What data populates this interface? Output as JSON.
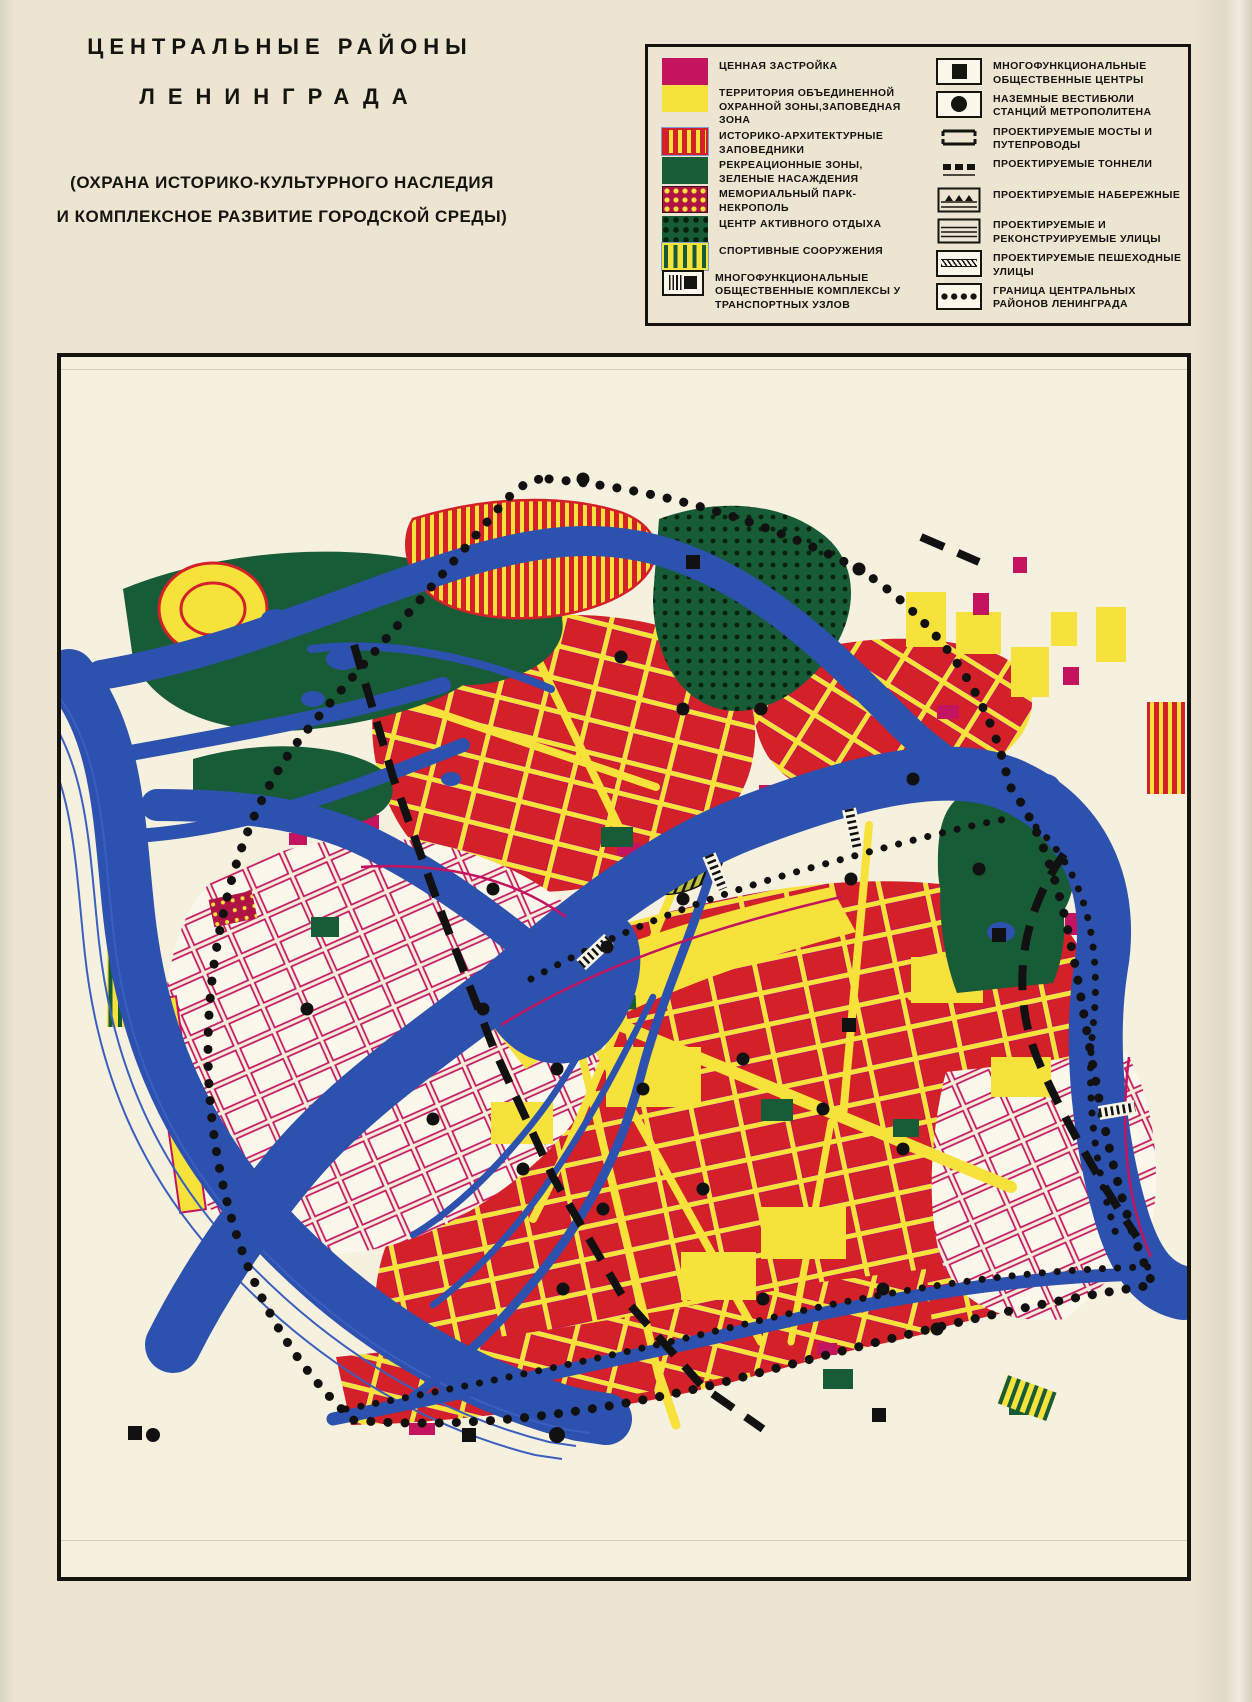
{
  "title": {
    "line1": "ЦЕНТРАЛЬНЫЕ РАЙОНЫ",
    "line2": "ЛЕНИНГРАДА",
    "subtitle_line1": "(ОХРАНА ИСТОРИКО-КУЛЬТУРНОГО НАСЛЕДИЯ",
    "subtitle_line2": "И КОМПЛЕКСНОЕ РАЗВИТИЕ ГОРОДСКОЙ СРЕДЫ)"
  },
  "legend": {
    "left": [
      {
        "id": "valuable-buildings",
        "swatch": "solid-crimson",
        "label": "ЦЕННАЯ ЗАСТРОЙКА"
      },
      {
        "id": "protected-zone",
        "swatch": "solid-yellow",
        "label": "ТЕРРИТОРИЯ ОБЪЕДИНЕННОЙ ОХРАННОЙ ЗОНЫ,ЗАПОВЕДНАЯ ЗОНА"
      },
      {
        "id": "historic-architectural-reserves",
        "swatch": "stripes-red-yellow",
        "label": "ИСТОРИКО-АРХИТЕКТУРНЫЕ ЗАПОВЕДНИКИ"
      },
      {
        "id": "recreation-zones",
        "swatch": "solid-green",
        "label": "РЕКРЕАЦИОННЫЕ ЗОНЫ, ЗЕЛЕНЫЕ НАСАЖДЕНИЯ"
      },
      {
        "id": "memorial-park-necropolis",
        "swatch": "dots-yellow-on-crimson",
        "label": "МЕМОРИАЛЬНЫЙ ПАРК-НЕКРОПОЛЬ"
      },
      {
        "id": "active-recreation-center",
        "swatch": "dots-black-on-green",
        "label": "ЦЕНТР АКТИВНОГО ОТДЫХА"
      },
      {
        "id": "sports-facilities",
        "swatch": "stripes-green-yellow",
        "label": "СПОРТИВНЫЕ СООРУЖЕНИЯ"
      },
      {
        "id": "transport-hub-complexes",
        "swatch": "glyph-transport-complex",
        "label": "МНОГОФУНКЦИОНАЛЬНЫЕ ОБЩЕСТВЕННЫЕ КОМПЛЕКСЫ У ТРАНСПОРТНЫХ УЗЛОВ"
      }
    ],
    "right": [
      {
        "id": "public-centers",
        "swatch": "glyph-square",
        "label": "МНОГОФУНКЦИОНАЛЬНЫЕ ОБЩЕСТВЕННЫЕ ЦЕНТРЫ"
      },
      {
        "id": "metro-vestibules",
        "swatch": "glyph-circle",
        "label": "НАЗЕМНЫЕ ВЕСТИБЮЛИ СТАНЦИЙ МЕТРОПОЛИТЕНА"
      },
      {
        "id": "planned-bridges",
        "swatch": "glyph-bridge",
        "label": "ПРОЕКТИРУЕМЫЕ МОСТЫ И ПУТЕПРОВОДЫ"
      },
      {
        "id": "planned-tunnels",
        "swatch": "glyph-tunnel",
        "label": "ПРОЕКТИРУЕМЫЕ ТОННЕЛИ"
      },
      {
        "id": "planned-embankments",
        "swatch": "glyph-embankment",
        "label": "ПРОЕКТИРУЕМЫЕ НАБЕРЕЖНЫЕ"
      },
      {
        "id": "planned-streets",
        "swatch": "glyph-streets",
        "label": "ПРОЕКТИРУЕМЫЕ И РЕКОНСТРУИРУЕМЫЕ УЛИЦЫ"
      },
      {
        "id": "pedestrian-streets",
        "swatch": "glyph-pedestrian",
        "label": "ПРОЕКТИРУЕМЫЕ ПЕШЕХОДНЫЕ УЛИЦЫ"
      },
      {
        "id": "central-districts-boundary",
        "swatch": "glyph-boundary",
        "label": "ГРАНИЦА ЦЕНТРАЛЬНЫХ РАЙОНОВ ЛЕНИНГРАДА"
      }
    ]
  },
  "palette": {
    "paper": "#ece5d2",
    "map_paper": "#f6f0de",
    "ink": "#16140f",
    "red": "#d42029",
    "crimson": "#c4135f",
    "yellow": "#f7e23b",
    "blue": "#2c51ae",
    "green": "#175c36",
    "white_block": "#fbf7ea"
  }
}
